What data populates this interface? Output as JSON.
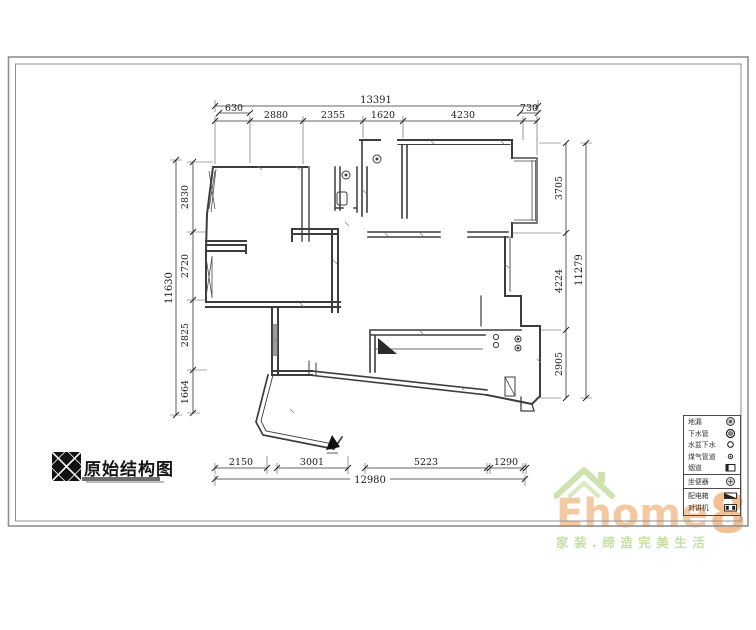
{
  "sheet": {
    "bg": "#ffffff",
    "frame_color": "#8f8f8f",
    "line_color": "#3d3d3d"
  },
  "title_block": {
    "title": "原始结构图",
    "logo_letters": {
      "top": "A",
      "left": "D",
      "right": "B"
    }
  },
  "dimensions": {
    "top": {
      "total": "13391",
      "segments": [
        "630",
        "2880",
        "2355",
        "1620",
        "4230",
        "730"
      ]
    },
    "left": {
      "total": "11630",
      "segments": [
        "2830",
        "2720",
        "2825",
        "1664"
      ]
    },
    "right": {
      "total": "11279",
      "segments": [
        "3705",
        "4224",
        "2905"
      ]
    },
    "bottom": {
      "total": "12980",
      "segments": [
        "2150",
        "3001",
        "5223",
        "1290"
      ]
    }
  },
  "legend": {
    "rows": [
      {
        "label": "地漏",
        "symbol": "floor-drain"
      },
      {
        "label": "下水管",
        "symbol": "sewer-pipe"
      },
      {
        "label": "水盆下水",
        "symbol": "basin-drain"
      },
      {
        "label": "煤气管道",
        "symbol": "gas-pipe"
      },
      {
        "label": "烟道",
        "symbol": "flue"
      },
      {
        "label": "坐便器",
        "symbol": "toilet"
      },
      {
        "label": "配电箱",
        "symbol": "power-box"
      },
      {
        "label": "对讲机",
        "symbol": "intercom"
      }
    ]
  },
  "watermark": {
    "brand_text": "Ehome",
    "brand_digit": "8",
    "tagline": "家装.缔造完美生活",
    "brand_color": "#f4c9a2",
    "accent_green": "#cfe3b0"
  }
}
